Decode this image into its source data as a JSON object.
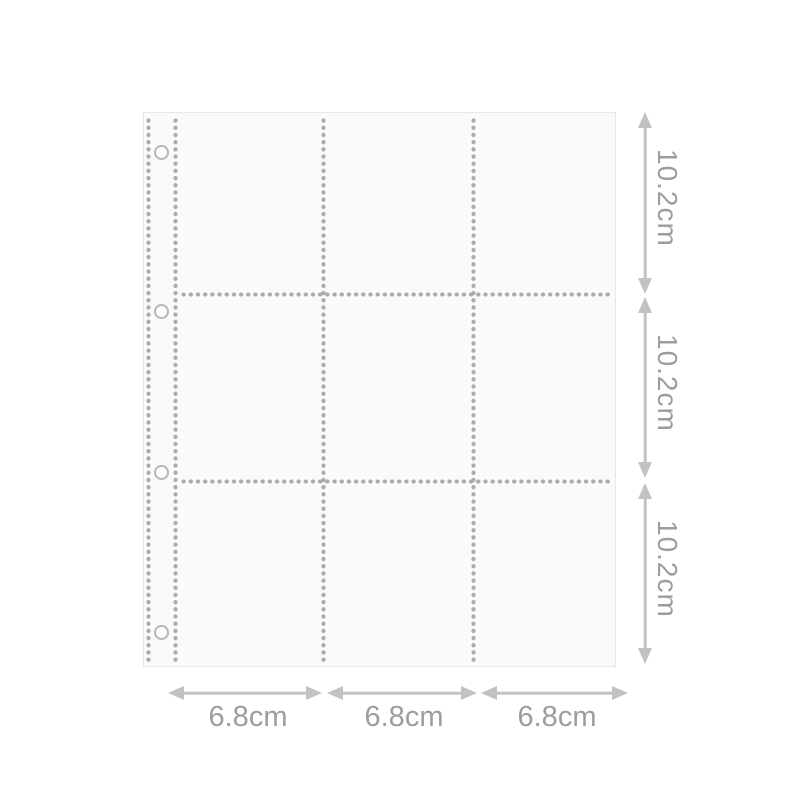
{
  "diagram": {
    "subject": "3x3 pocket binder page with stitched dotted seams and binder holes",
    "pocket_rows": 3,
    "pocket_columns": 3,
    "binder_holes": 4
  },
  "dimensions": {
    "row_labels": [
      "10.2cm",
      "10.2cm",
      "10.2cm"
    ],
    "col_labels": [
      "6.8cm",
      "6.8cm",
      "6.8cm"
    ]
  },
  "icons": {
    "row_arrow": "double-headed-vertical-arrow",
    "col_arrow": "double-headed-horizontal-arrow"
  },
  "colors": {
    "page_bg": "#fafafa",
    "page_border": "#e8e8e8",
    "dot": "#ababab",
    "hole_ring": "#b6b6b6",
    "arrow": "#c2c2c2",
    "label": "#9d9d9d"
  }
}
